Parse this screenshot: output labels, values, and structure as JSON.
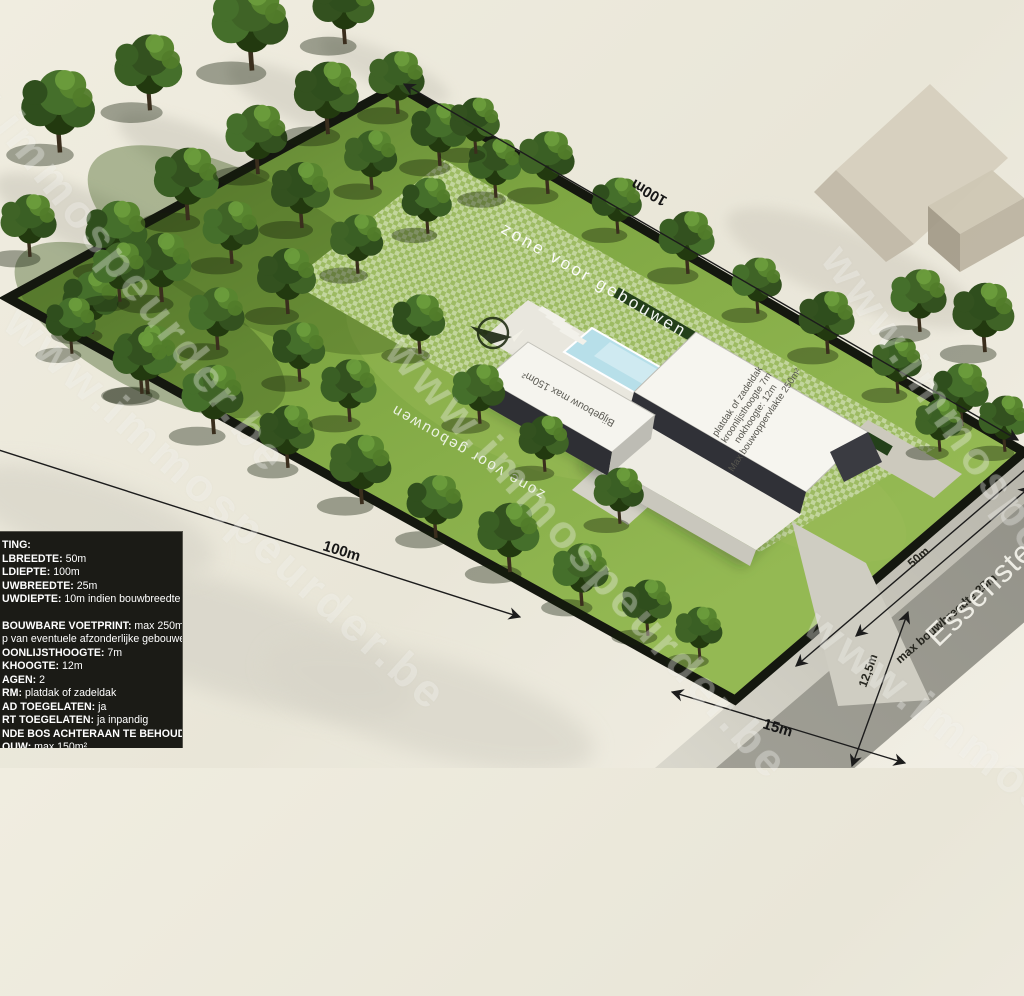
{
  "watermark": {
    "text": "www.immospeurder.be"
  },
  "zone": {
    "label": "zone voor gebouwen",
    "label_secondary": "zone voor gebouwen"
  },
  "dimensions": {
    "depth_left": "100m",
    "depth_top": "100m",
    "front_setback": "15m",
    "frontage": "50m",
    "max_build_width": "max bouwbreedte 25m",
    "road_width": "12,5m"
  },
  "road": {
    "name": "Essensteenweg"
  },
  "buildings": {
    "bijgebouw_roof_label": "Bijgebouw max 150m²",
    "main_roof_lines": [
      "platdak of zadeldak",
      "kroonlijsthoogte 7m",
      "nokhoogte: 12m",
      "Max bouwoppervlakte 250m²"
    ]
  },
  "info_panel": {
    "lines": [
      {
        "label": "TING:",
        "value": ""
      },
      {
        "label": "LBREEDTE:",
        "value": "50m"
      },
      {
        "label": "LDIEPTE:",
        "value": "100m"
      },
      {
        "label": "UWBREEDTE:",
        "value": "25m"
      },
      {
        "label": "UWDIEPTE:",
        "value": "10m indien bouwbreedte"
      },
      {
        "label": "",
        "value": ""
      },
      {
        "label": "BOUWBARE VOETPRINT:",
        "value": "max 250m²"
      },
      {
        "label": "",
        "value": "p van eventuele afzonderlijke gebouwen"
      },
      {
        "label": "OONLIJSTHOOGTE:",
        "value": "7m"
      },
      {
        "label": "KHOOGTE:",
        "value": "12m"
      },
      {
        "label": "AGEN:",
        "value": "2"
      },
      {
        "label": "RM:",
        "value": "platdak of zadeldak"
      },
      {
        "label": "AD TOEGELATEN:",
        "value": "ja"
      },
      {
        "label": "RT TOEGELATEN:",
        "value": "ja inpandig"
      },
      {
        "label": "NDE BOS ACHTERAAN TE BEHOUDEN",
        "value": ""
      },
      {
        "label": "OUW:",
        "value": "max 150m²"
      }
    ]
  },
  "colors": {
    "grass": "#7ea642",
    "hedge": "#14170f",
    "road": "#908f85",
    "verge": "#b5b3a7",
    "pool": "#b7dfe9",
    "panel_bg": "#1b1b16",
    "house_white": "#f6f5ef",
    "house_dark": "#303137",
    "neighbor_beige": "#d7d0bf"
  }
}
